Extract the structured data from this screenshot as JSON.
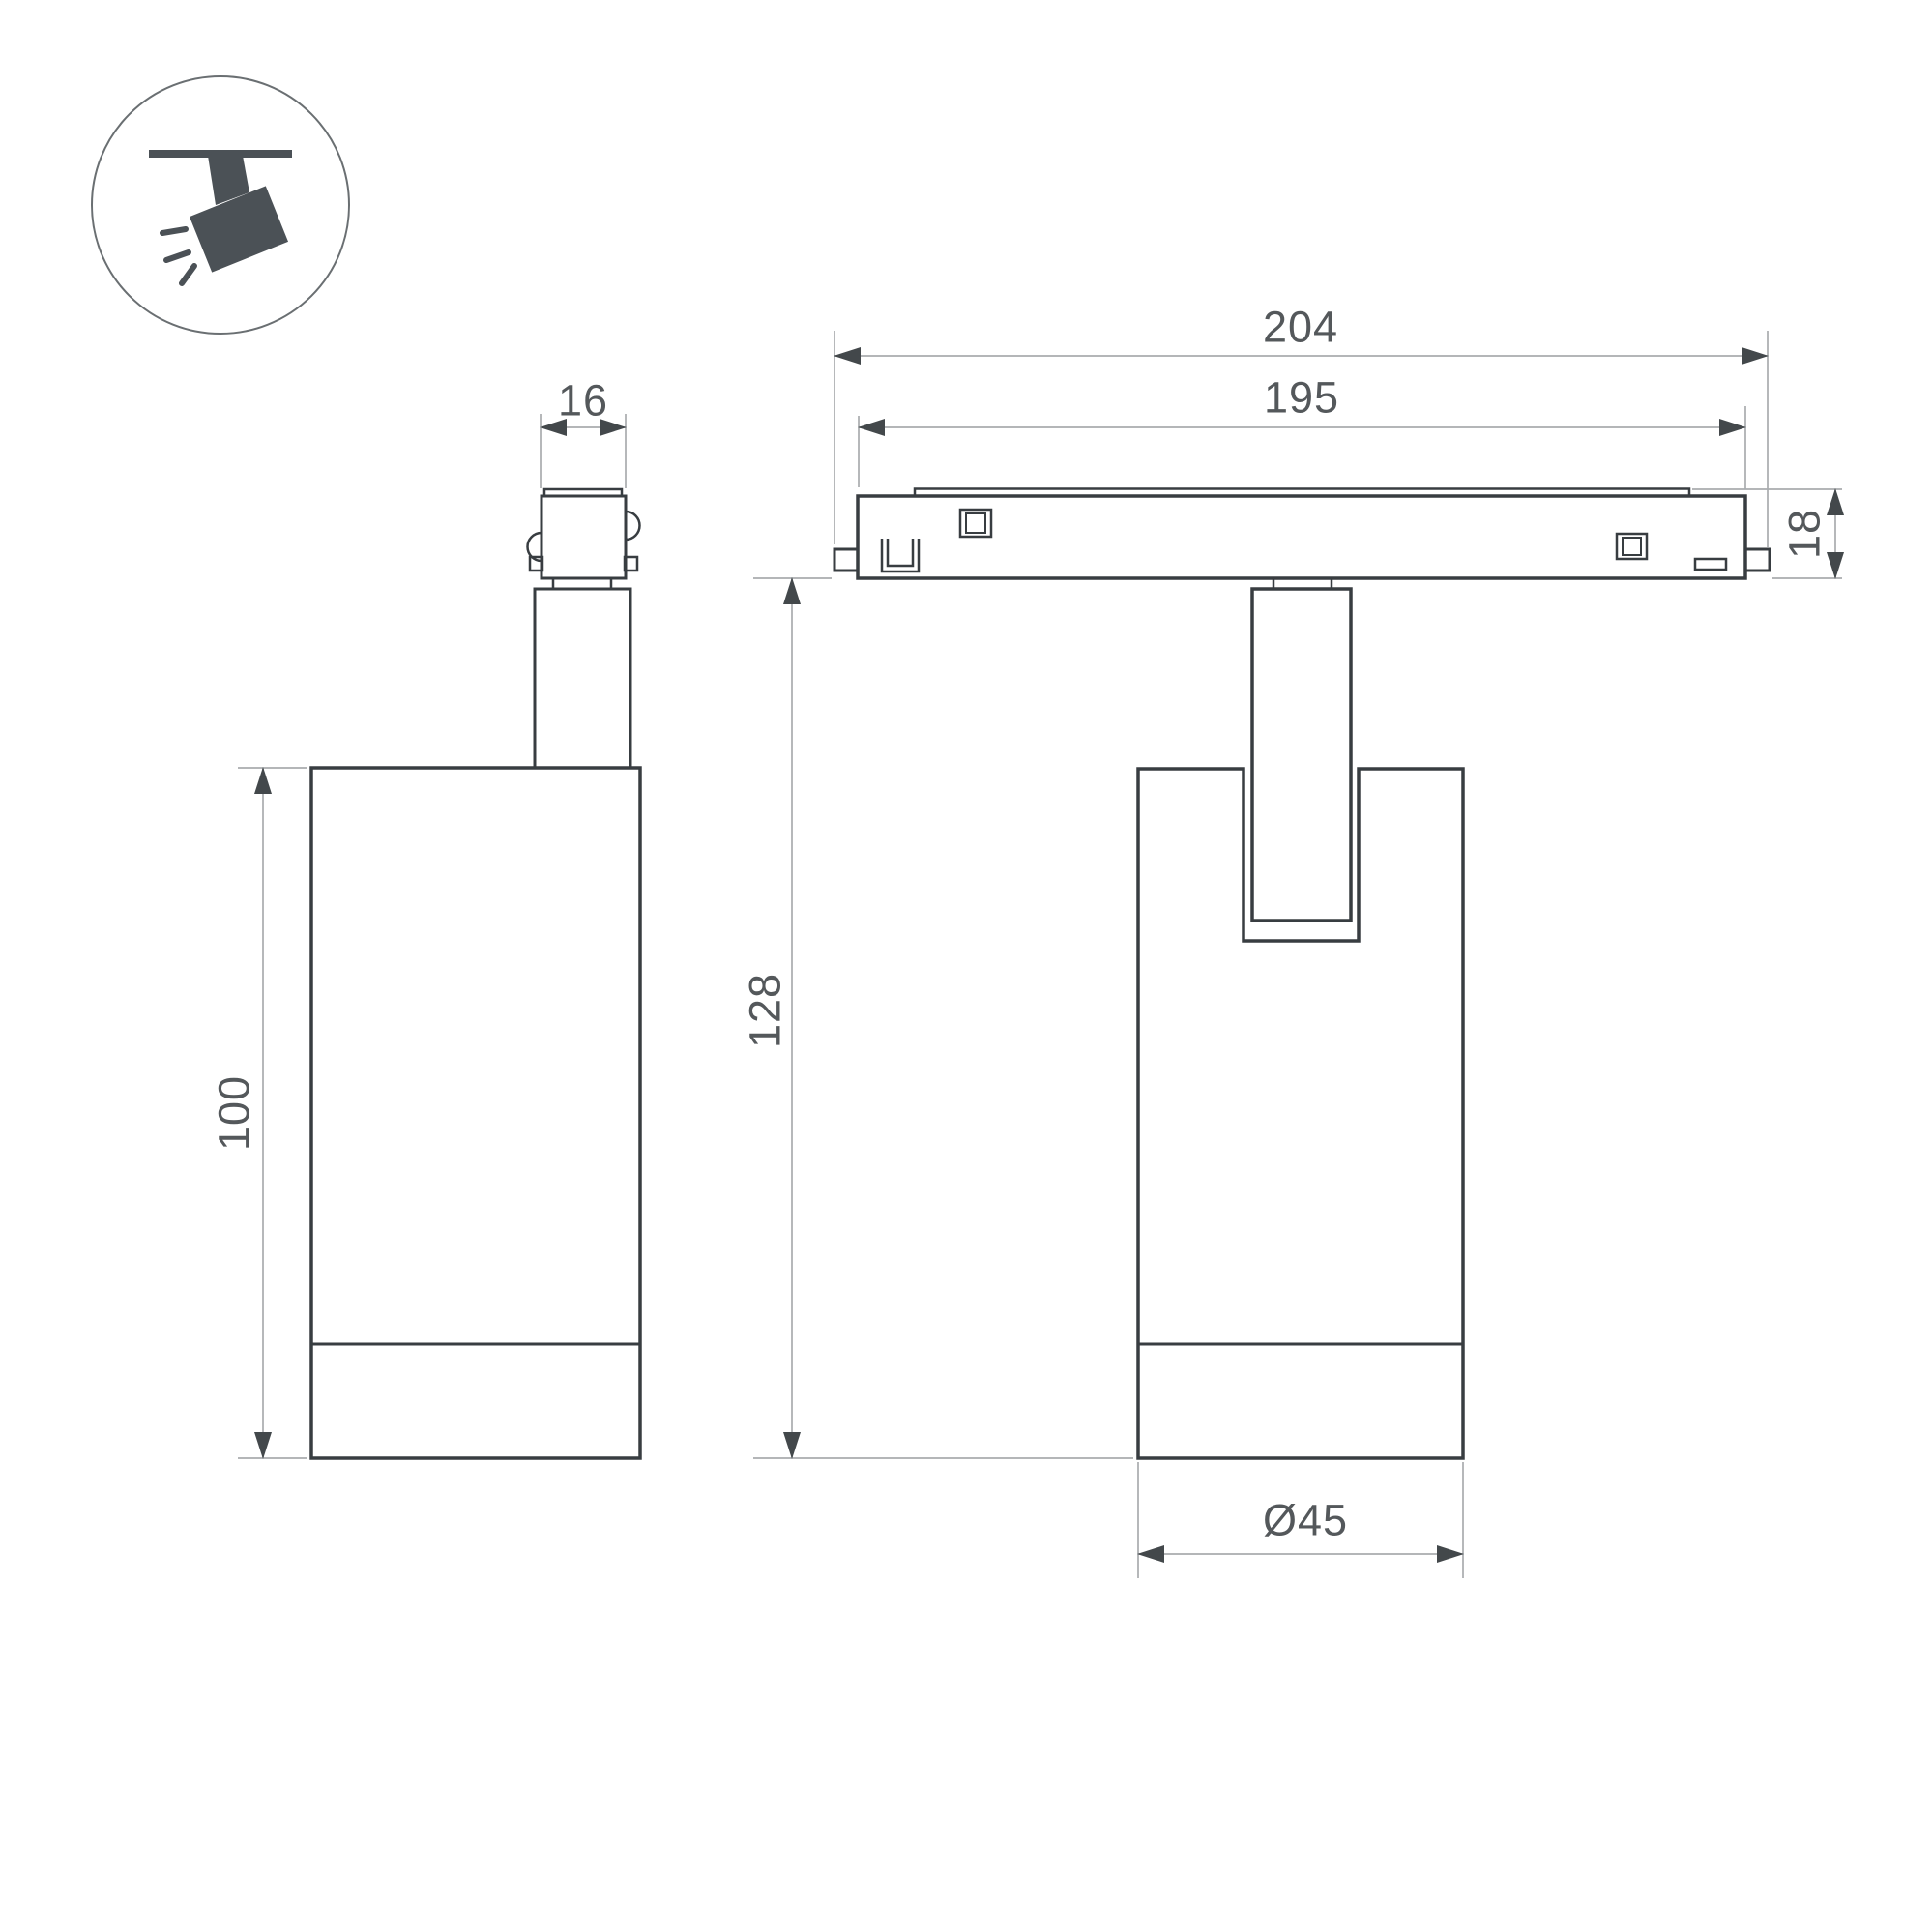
{
  "document": {
    "type": "dimensioned line drawing, two orthographic views of a track-mounted spotlight",
    "icon": "track-spotlight"
  },
  "dims": {
    "adapter_width": "16",
    "body_height": "100",
    "track_length": "204",
    "rail_length": "195",
    "track_height": "18",
    "overall_height": "128",
    "body_diameter": "Ø45"
  },
  "colors": {
    "line": "#383d41",
    "dim": "#a9acae",
    "arrow": "#43484b",
    "text": "#54585b",
    "icon": "#4b5156",
    "circle": "#6a6f72",
    "background": "#ffffff"
  }
}
